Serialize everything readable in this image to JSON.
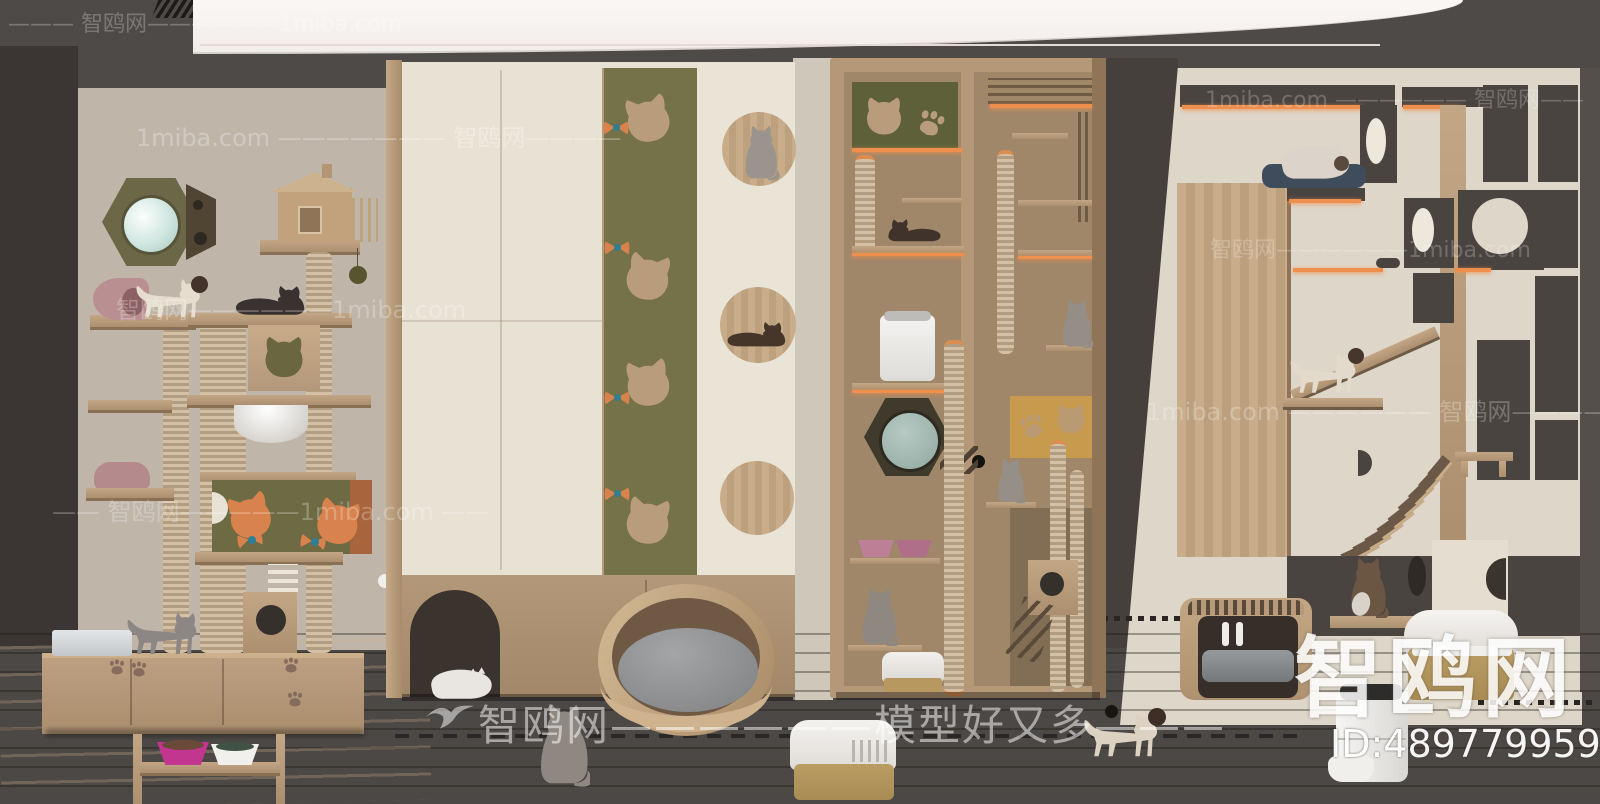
{
  "watermarks": {
    "brand": "智鸥网",
    "site": "1miba.com",
    "slogan": "模型好又多",
    "rows": [
      {
        "text": "——— 智鸥网——————1miba.com"
      },
      {
        "text": "1miba.com ——————— 智鸥网————"
      },
      {
        "text": "1miba.com —————— 智鸥网——"
      },
      {
        "text": "智鸥网——————1miba.com"
      },
      {
        "text": "智鸥网——————1miba.com"
      },
      {
        "text": "1miba.com —————— 智鸥网————"
      },
      {
        "text": "—— 智鸥网—————1miba.com ——"
      },
      {
        "text": "智鸥网——————模型好又多———"
      }
    ],
    "logo_text": "智鸥网",
    "id_text": "ID:489779959"
  },
  "colors": {
    "ceiling": "#4c4845",
    "left_wall": "#3b3633",
    "back_wall": "#c0b5a9",
    "cream": "#e8e2d5",
    "olive": "#73704a",
    "wood": "#b79a7a",
    "charcoal": "#4a4440",
    "led_orange": "#ee8d4d",
    "accent_orange": "#d8824d",
    "teal_dot": "#2f7f94",
    "magenta_bowl": "#c2368f",
    "navy_cushion": "#3f4c5c",
    "floor_dark": "#3e372f"
  }
}
